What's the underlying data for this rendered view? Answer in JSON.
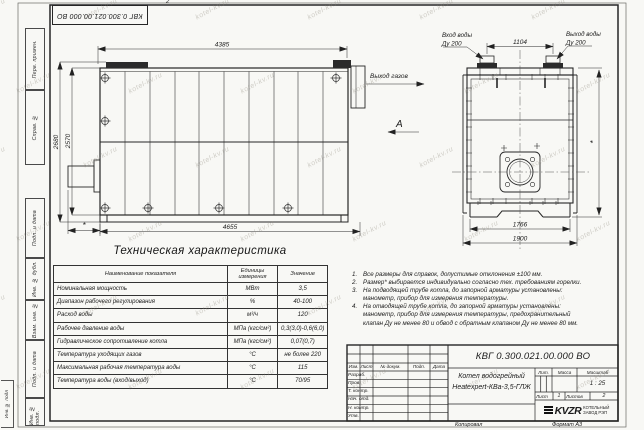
{
  "watermark": "kotel-kv.ru",
  "sheet": {
    "zone_mark": "2",
    "left_column_labels": [
      "Перв. примен.",
      "Справ. №",
      "Подп. и дата",
      "Инв. № дубл.",
      "Взам. инв. №",
      "Подп. и дата",
      "Инв. № подл."
    ],
    "corner_label": "Инв. № подл"
  },
  "side_view": {
    "dim_top": "4385",
    "dim_bottom": "4655",
    "dim_height_outer": "2680",
    "dim_height_inner": "2570",
    "dim_asterisk": "*",
    "gas_outlet_label": "Выход газов",
    "view_label": "А"
  },
  "front_view": {
    "water_inlet_line1": "Вход воды",
    "water_inlet_line2": "Ду 200",
    "water_outlet_line1": "Выход воды",
    "water_outlet_line2": "Ду 200",
    "dim_nozzle_spacing": "1104",
    "dim_width_inner": "1766",
    "dim_width_outer": "1900",
    "dim_asterisk": "*"
  },
  "tech_table": {
    "title": "Техническая характеристика",
    "col_headers": [
      "Наименование показателя",
      "Единицы измерения",
      "Значение"
    ],
    "rows": [
      {
        "name": "Номинальная мощность",
        "unit": "МВт",
        "value": "3,5"
      },
      {
        "name": "Диапазон рабочего регулирования",
        "unit": "%",
        "value": "40-100"
      },
      {
        "name": "Расход воды",
        "unit": "м³/ч",
        "value": "120"
      },
      {
        "name": "Рабочее давление воды",
        "unit": "МПа (кгс/см²)",
        "value": "0,3(3,0)-0,6(6,0)"
      },
      {
        "name": "Гидравлическое сопротивление котла",
        "unit": "МПа (кгс/см²)",
        "value": "0,07(0,7)"
      },
      {
        "name": "Температура уходящих газов",
        "unit": "°С",
        "value": "не более 220"
      },
      {
        "name": "Максимальная рабочая температура воды",
        "unit": "°С",
        "value": "115"
      },
      {
        "name": "Температура воды (вход/выход)",
        "unit": "°С",
        "value": "70/95"
      }
    ]
  },
  "notes": [
    {
      "num": "1.",
      "text": "Все размеры для справок, допустимые отклонения ±100 мм."
    },
    {
      "num": "2.",
      "text": "Размер* выбирается индивидуально согласно тех. требованиям горелки."
    },
    {
      "num": "3.",
      "text": "На подводящей трубе котла, до запорной арматуры установлены: манометр, прибор для измерения температуры."
    },
    {
      "num": "4.",
      "text": "На отводящей трубе котла, до запорной арматуры установлены: манометр, прибор для измерения температуры, предохранительный клапан Ду не менее 80 и обвод с обратным клапаном Ду не менее 80 мм."
    }
  ],
  "title_block": {
    "doc_number": "КВГ 0.300.021.00.000 ВО",
    "product_name_line1": "Котел водогрейный",
    "product_name_line2": "Heatexpert-КВа-3,5-ГЛЖ",
    "header_cols": [
      "Изм.",
      "Лист",
      "№ докум.",
      "Подп.",
      "Дата"
    ],
    "row_labels": [
      "Разраб.",
      "Пров.",
      "Т. контр.",
      "Нач. отд.",
      "Н. контр.",
      "Утв."
    ],
    "lit_label": "Лит.",
    "mass_label": "Масса",
    "scale_label": "Масштаб",
    "scale_value": "1 : 25",
    "sheet_label": "Лист",
    "sheet_value": "1",
    "sheets_label": "Листов",
    "sheets_value": "2",
    "company_logo": "KVZR",
    "company_line1": "КОТЕЛЬНЫЙ",
    "company_line2": "ЗАВОД РЭП",
    "copied_label": "Копировал",
    "format_label": "Формат А3"
  }
}
